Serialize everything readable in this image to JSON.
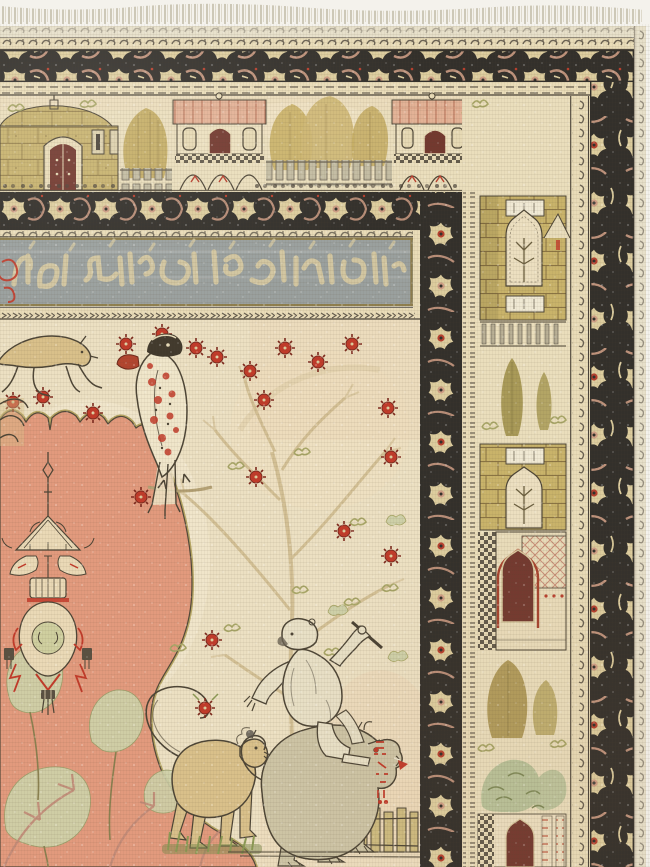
{
  "artwork": {
    "type": "photograph",
    "label": "Antique Anatolian pictorial prayer rug — corner detail",
    "style": "Kayseri/Sivas pictorial rug with village band, calligraphy cartouche and animal field"
  },
  "palette": {
    "white": "#f4f2ec",
    "fringe": "#c6c0ae",
    "selvage": "#e7e0ca",
    "borderGround": "#33302b",
    "flowerCream": "#ddcd9e",
    "flowerPink": "#cf9e85",
    "accentRed": "#b8402e",
    "guardCream": "#e9dcb8",
    "guardMark": "#4b443a",
    "bandBg": "#eadebc",
    "stoneKhaki": "#c7b26e",
    "brickKhaki": "#c9b36a",
    "brickLine": "#8a7443",
    "roofPink": "#e3b296",
    "roofLine": "#c07d62",
    "doorMaroon": "#73392f",
    "treeOlive": "#ab9551",
    "fenceGray": "#c3bca2",
    "calligGround": "#9aa09e",
    "calligScript": "#d7caa2",
    "frameKhaki": "#8f7f4e",
    "fieldCream": "#ece0c2",
    "medallionSalmon": "#e29a7d",
    "medallionLight": "#eec4a4",
    "outline": "#4d4536",
    "rosetteRed": "#c23b2a",
    "rosetteDark": "#7e2a1e",
    "leafOlive": "#a9a768",
    "leafPale": "#ced0a8",
    "animalTan": "#d9c08a",
    "shagBody": "#cdc4a5",
    "shagStroke": "#57514a",
    "monkeyCream": "#e8e0c6",
    "grassGreen": "#8c9a55",
    "lampCream": "#ead9b6",
    "lampGreen": "#cfcf9f",
    "treeFaint": "#cdb98b",
    "branchPink": "#c28b78"
  },
  "regions": {
    "fringe": {
      "label": "warp fringe along top edge"
    },
    "outer_border": {
      "label": "main border — cream palmettes on dark ground"
    },
    "architecture_band": {
      "label": "pictorial band — village houses, trees and fences"
    },
    "inner_border": {
      "label": "inner floral border"
    },
    "calligraphy_band": {
      "label": "inscription cartouche — woven calligraphy on grey ground"
    },
    "field": {
      "label": "ivory field — tree of life, parrot, lions, monkey, salmon medallion with hanging lamp"
    },
    "side_panel": {
      "label": "architectural side panel — brick towers, gardens and doorways"
    },
    "selvage": {
      "label": "selvage edge"
    }
  }
}
